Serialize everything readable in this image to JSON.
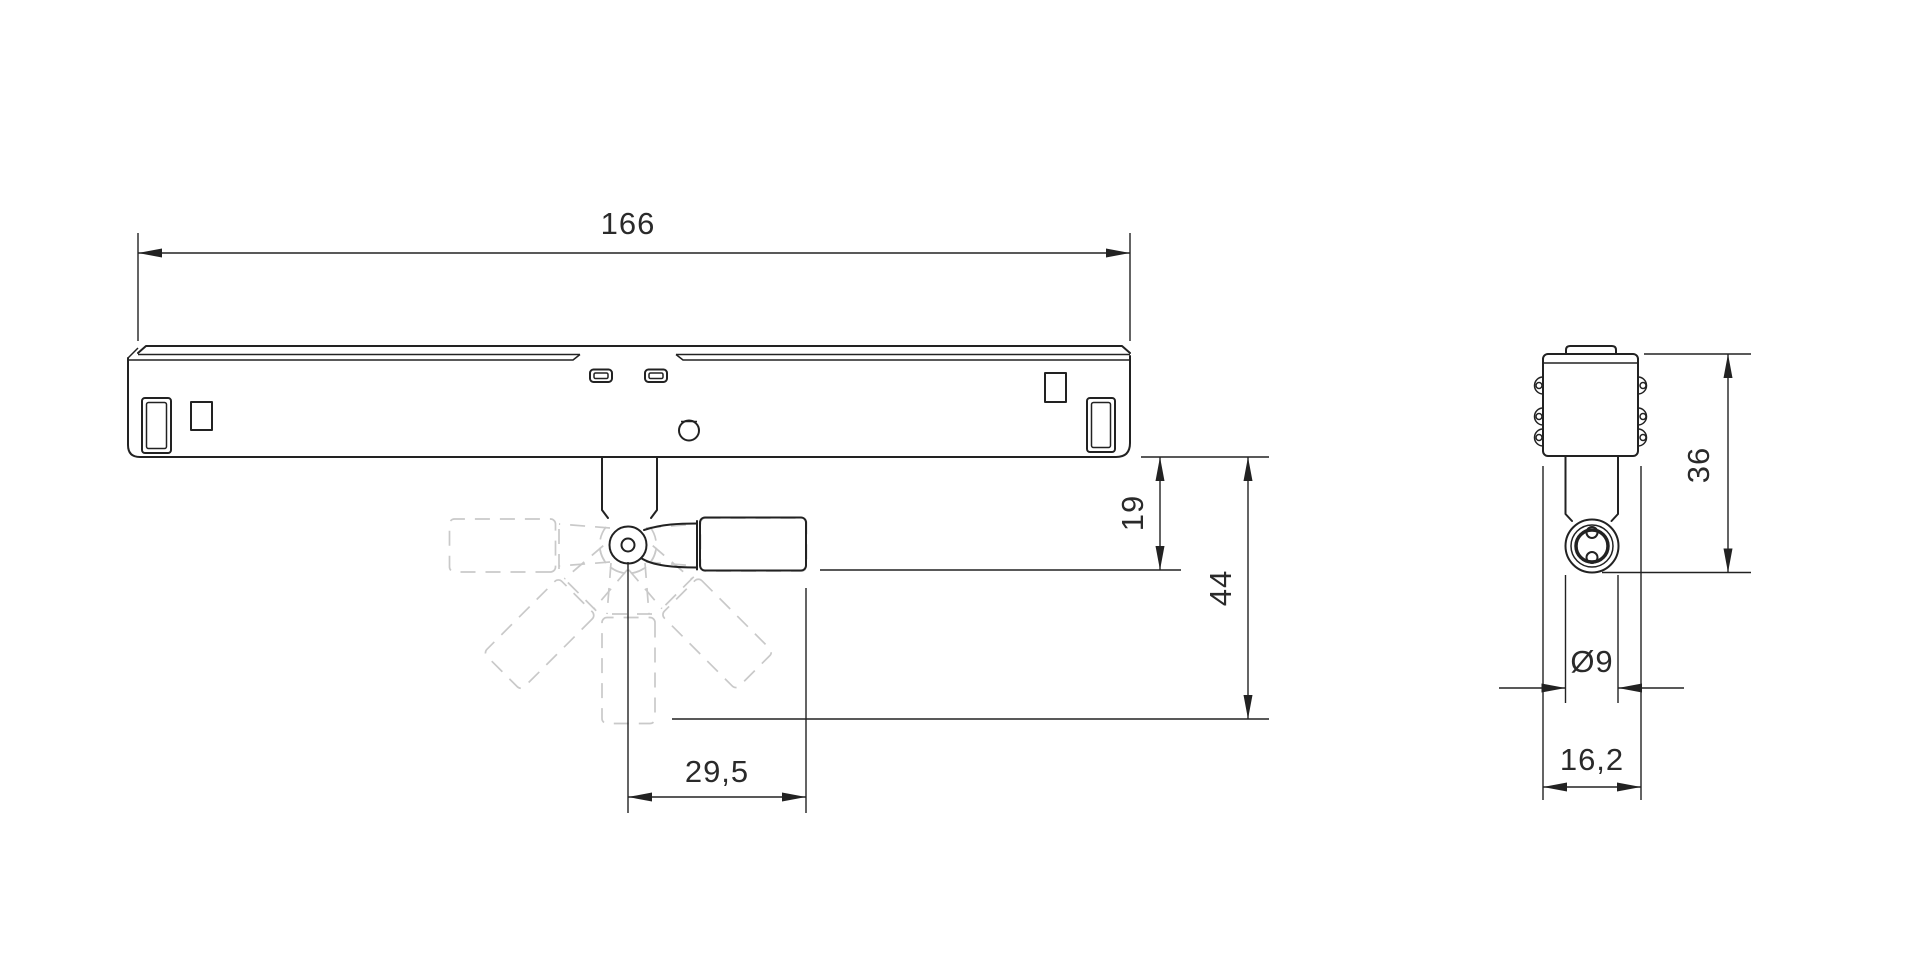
{
  "drawing": {
    "type": "technical-dimension-drawing",
    "colors": {
      "line": "#222222",
      "ghost": "#c9c9c9",
      "background": "#ffffff"
    },
    "dimensions": {
      "overall_length": "166",
      "pivot_drop": "19",
      "total_drop": "44",
      "arm_reach": "29,5",
      "side_height": "36",
      "barrel_diameter": "Ø9",
      "side_width": "16,2"
    }
  }
}
